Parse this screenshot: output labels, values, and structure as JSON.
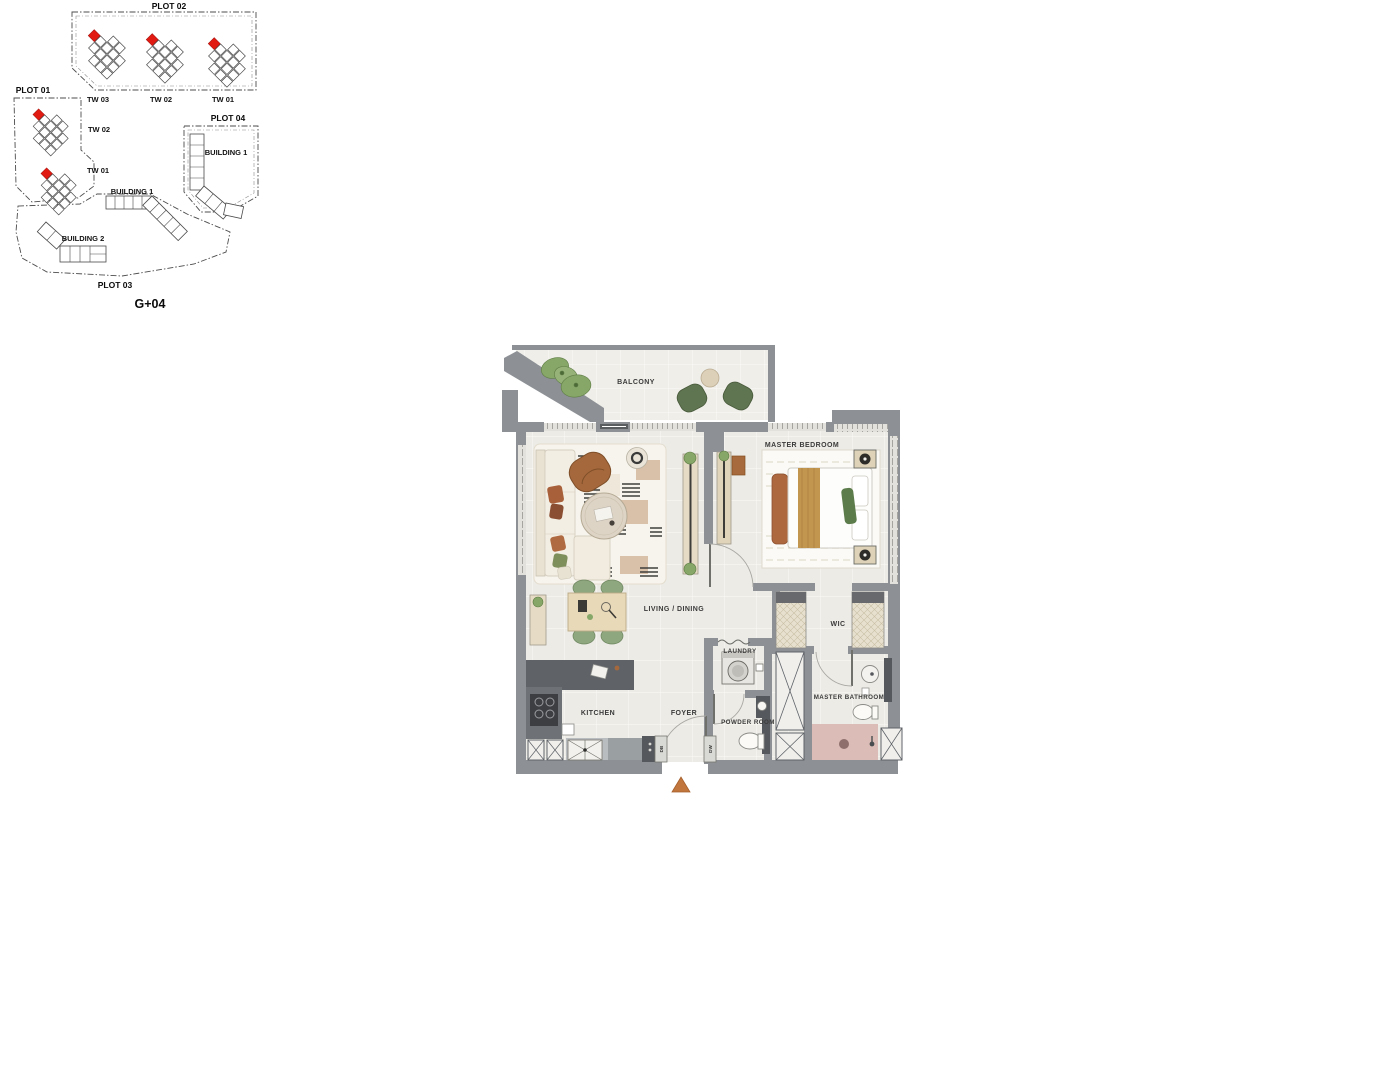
{
  "site_plan": {
    "title_level": "G+04",
    "plots": {
      "plot01": "PLOT 01",
      "plot02": "PLOT 02",
      "plot03": "PLOT 03",
      "plot04": "PLOT 04"
    },
    "towers": {
      "p2_tw03": "TW 03",
      "p2_tw02": "TW 02",
      "p2_tw01": "TW 01",
      "p1_tw02": "TW 02",
      "p1_tw01": "TW 01"
    },
    "buildings": {
      "p4_building1": "BUILDING 1",
      "p3_building1": "BUILDING 1",
      "p3_building2": "BUILDING 2"
    },
    "unit_marker_color": "#e11b12"
  },
  "floor_plan": {
    "rooms": {
      "balcony": "BALCONY",
      "master_bedroom": "MASTER BEDROOM",
      "living_dining": "LIVING / DINING",
      "wic": "WIC",
      "laundry": "LAUNDRY",
      "master_bathroom": "MASTER BATHROOM",
      "kitchen": "KITCHEN",
      "foyer": "FOYER",
      "powder_room": "POWDER ROOM"
    },
    "tags": {
      "db": "DB",
      "dw": "DW"
    },
    "colors": {
      "wall": "#8d9196",
      "floor": "#ecebe6",
      "shower": "#dbbcb6",
      "entry_arrow": "#c0763d",
      "greenery": "#86a768",
      "wood": "#e0d4ba",
      "counter_dark": "#4a4d50"
    }
  }
}
